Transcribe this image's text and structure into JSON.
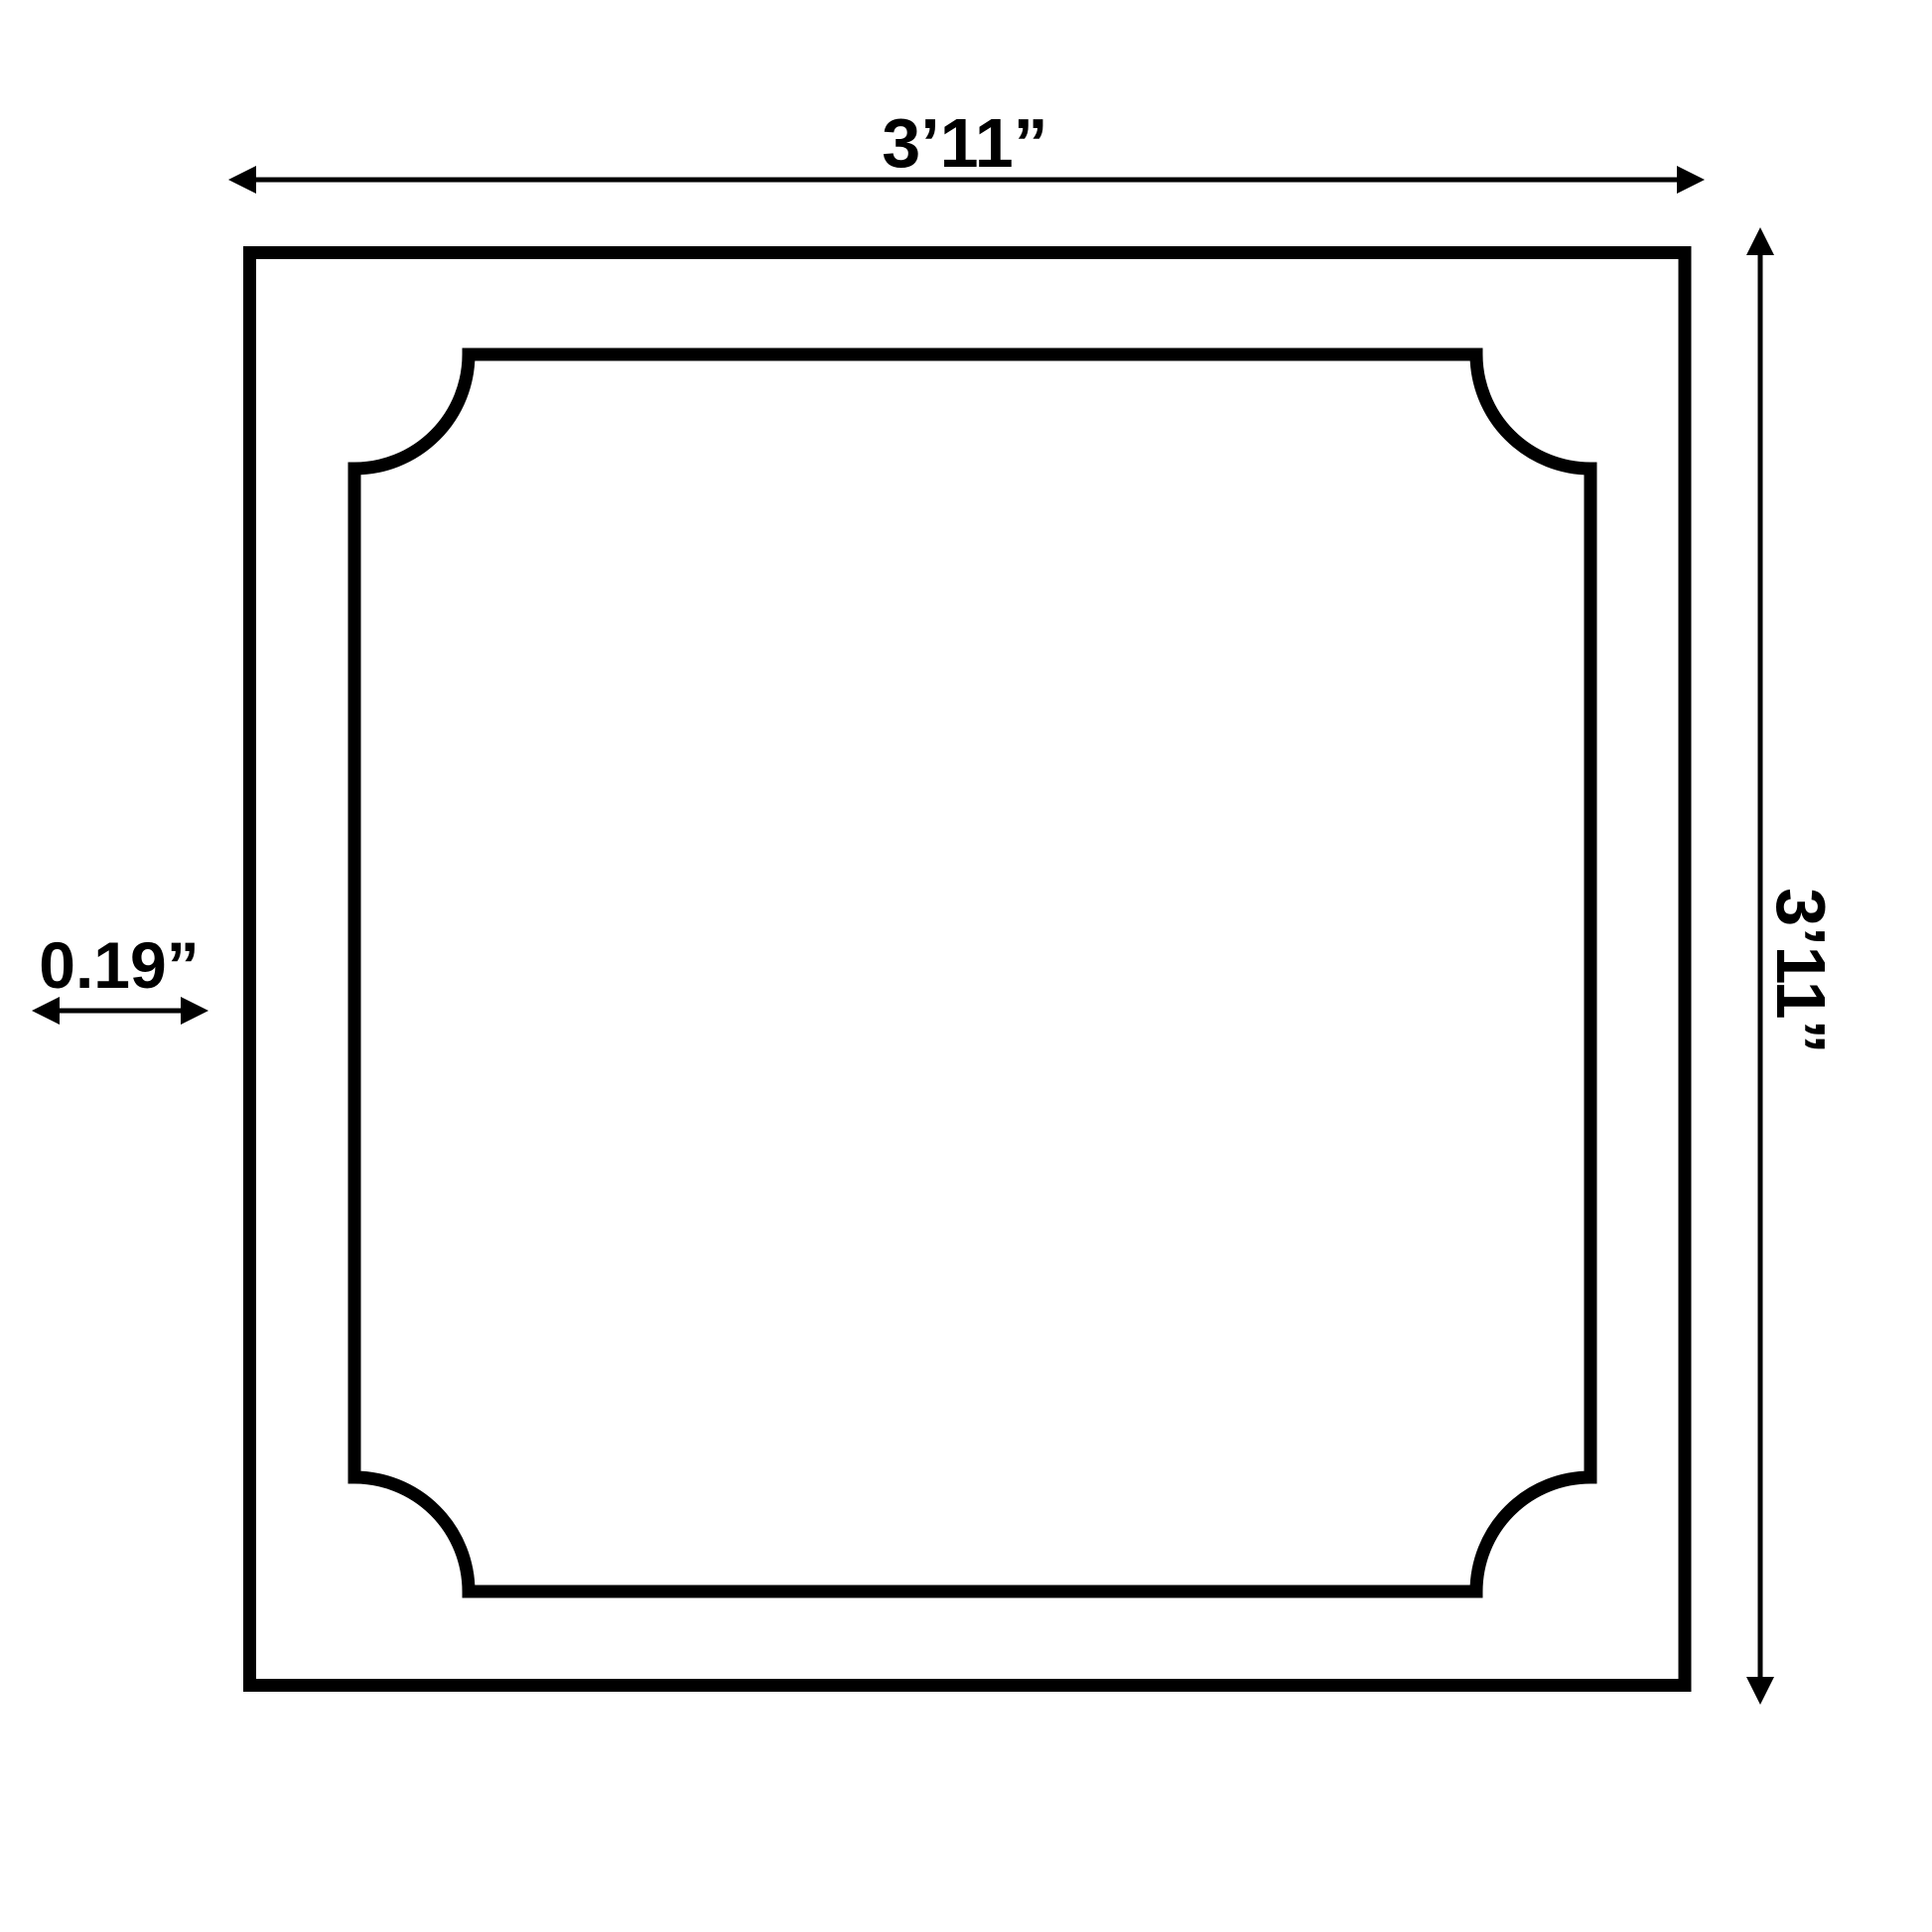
{
  "page": {
    "background": "#ffffff"
  },
  "diagram": {
    "kind": "square-panel-dimension-drawing",
    "line_color": "#000000",
    "labels": {
      "top_width": "3’11”",
      "right_height": "3’11”",
      "left_thickness": "0.19”"
    }
  }
}
